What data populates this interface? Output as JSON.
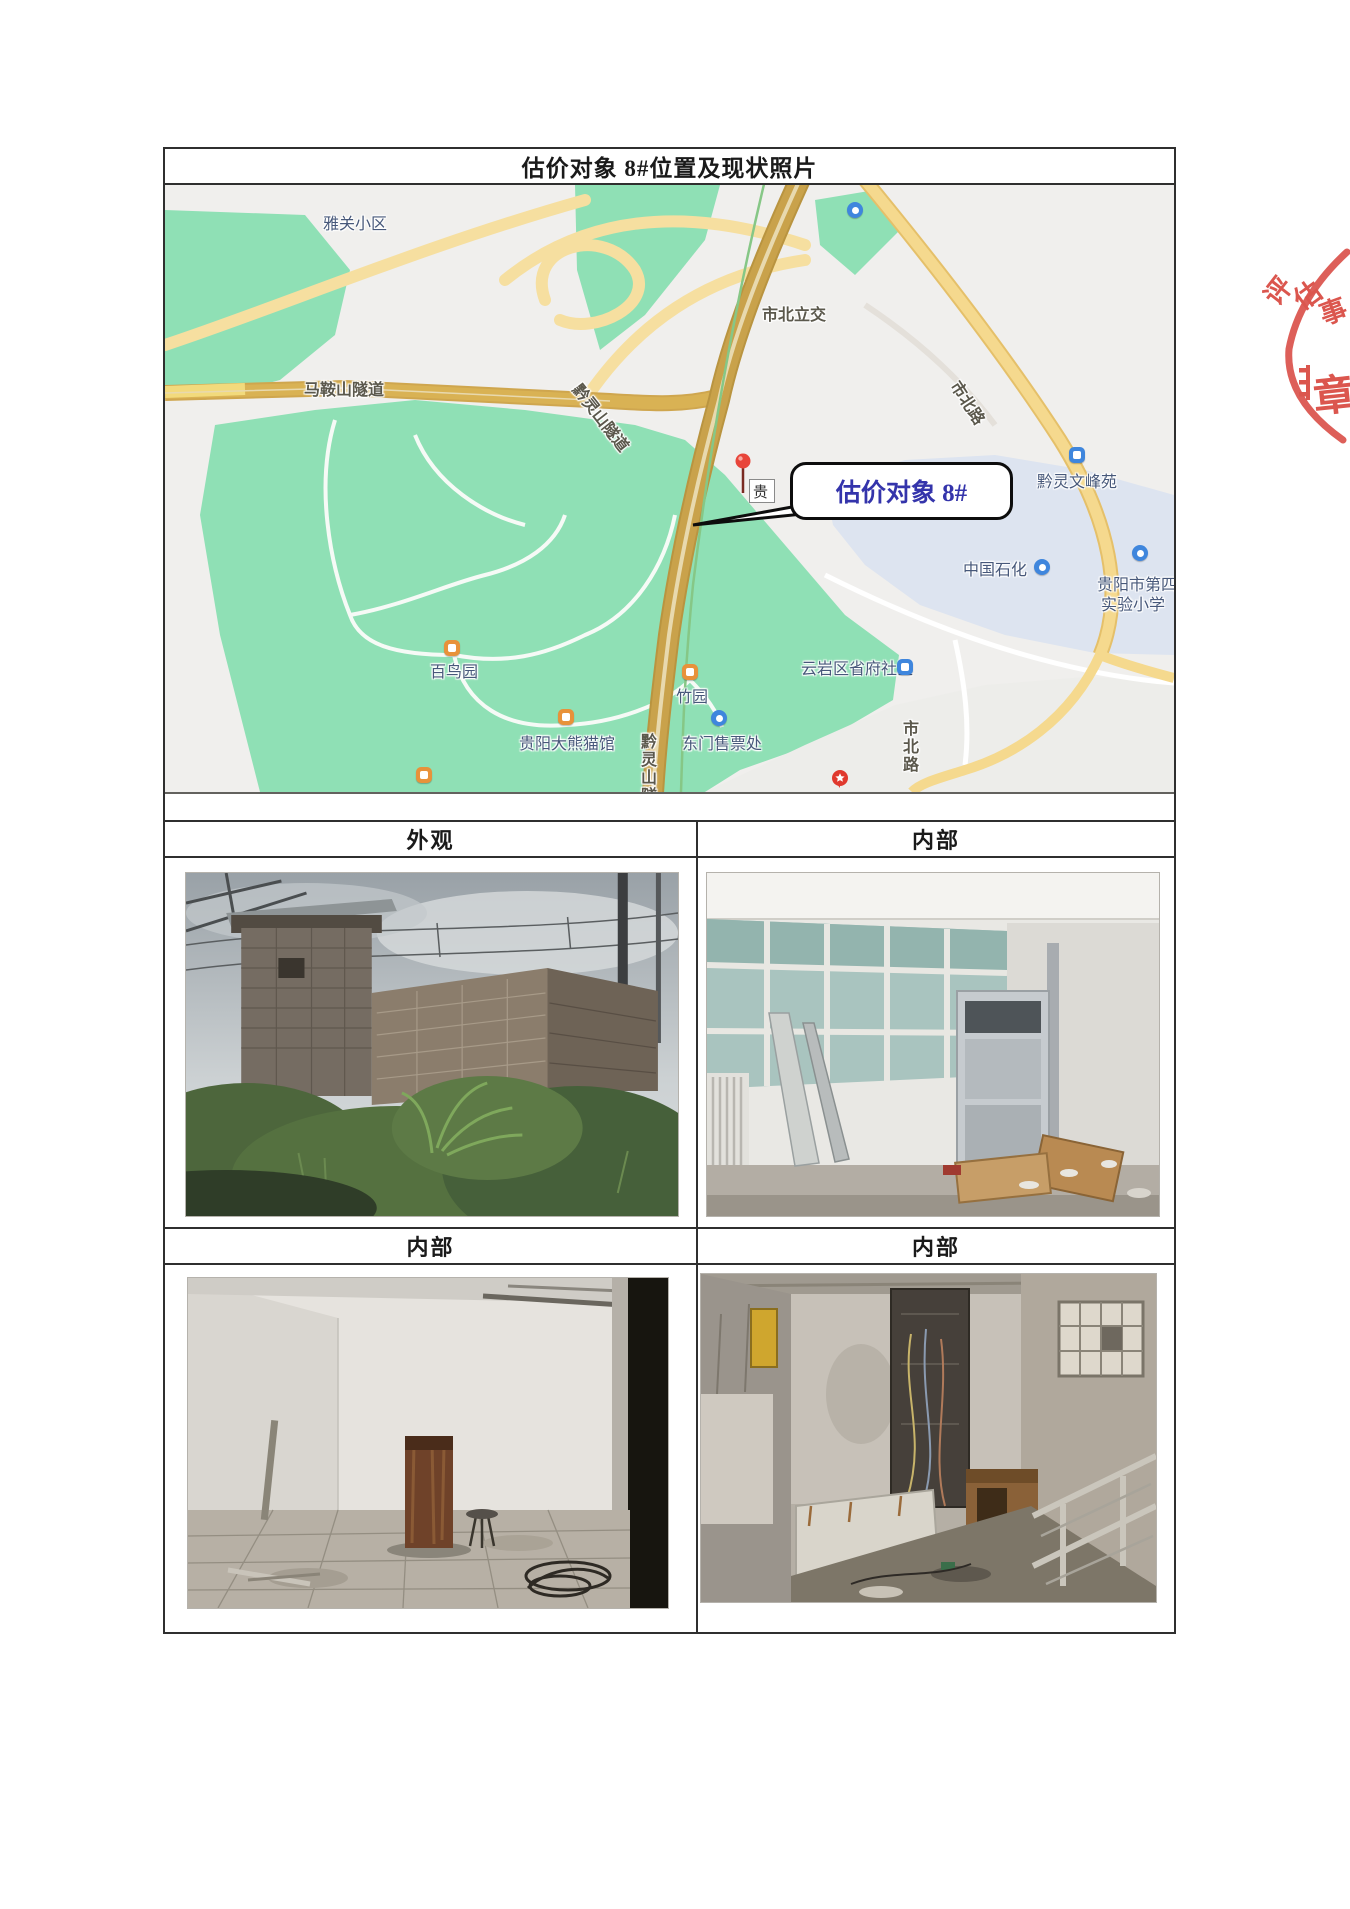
{
  "page": {
    "title": "估价对象 8#位置及现状照片"
  },
  "table": {
    "header_row_1": {
      "left": "外观",
      "right": "内部"
    },
    "header_row_2": {
      "left": "内部",
      "right": "内部"
    }
  },
  "map": {
    "callout": {
      "text": "估价对象 8#",
      "text_color": "#3434ab"
    },
    "pin_label": "贵",
    "labels": {
      "yaguan": "雅关小区",
      "shibei_lijiao": "市北立交",
      "maanshan": "马鞍山隧道",
      "qianlingshan_tunnel": "黔灵山隧道",
      "shibei_road_top": "市北路",
      "qianling_wenfeng": "黔灵文峰苑",
      "sinopec": "中国石化",
      "school_line1": "贵阳市第四",
      "school_line2": "实验小学",
      "community": "云岩区省府社区",
      "bainiao": "百鸟园",
      "zhuyuan": "竹园",
      "panda": "贵阳大熊猫馆",
      "ticket": "东门售票处",
      "qianlingshan_partial": "黔灵山隧",
      "shibei_road_bottom": "市北路"
    },
    "icon_names": [
      "museum-icon",
      "gas-station-icon",
      "school-icon",
      "community-icon",
      "housing-icon",
      "ticket-office-icon",
      "star-badge-icon",
      "location-pin-icon"
    ],
    "colors": {
      "park_green": "#8fe0b5",
      "district_blue": "#dde4f0",
      "road_main": "#c9a24b",
      "road_secondary": "#f6dfa0",
      "poi_blue": "#3f86dd",
      "poi_orange": "#e8923a"
    }
  },
  "stamp": {
    "arc_chars": [
      "评",
      "估",
      "事"
    ],
    "bottom_text": "章",
    "color": "#d84840"
  }
}
